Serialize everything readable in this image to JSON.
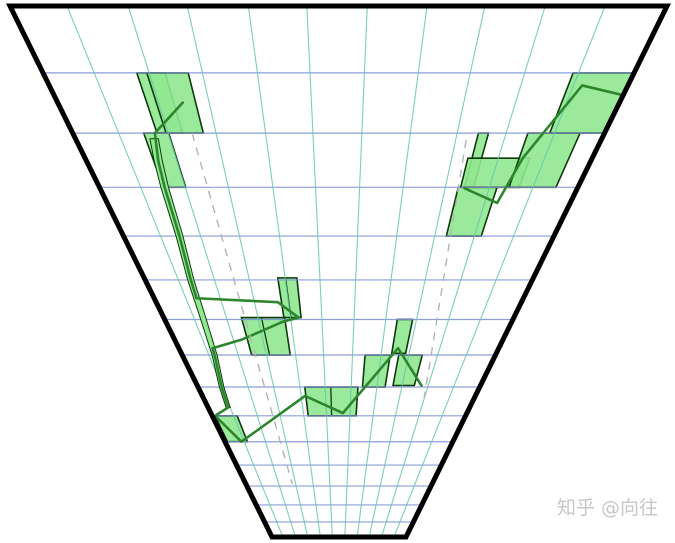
{
  "figure": {
    "width": 675,
    "height": 543,
    "background": "#ffffff"
  },
  "watermark": {
    "text": "知乎 @向往",
    "color": "#c7c7c7",
    "font_size": 19,
    "x": 658,
    "y": 514
  },
  "chart_data": {
    "type": "other",
    "description": "Perspective 'time funnel' rendering of a candlestick chart: light-green candle bodies with dark-green borders, a dark-green price polyline, two gray dashed trend rays, horizontal blue level lines and converging green vertical gridlines inside a thick black trapezoid frame.",
    "projection": {
      "vp_x": 339,
      "vp_y": 675,
      "scale": 669,
      "ratio": 0.9,
      "width_factor": 0.98206,
      "v_max": 15
    },
    "frame": {
      "corners": [
        [
          10,
          6
        ],
        [
          667,
          6
        ],
        [
          406,
          537
        ],
        [
          272,
          537
        ]
      ],
      "stroke": "#000000",
      "stroke_width": 5
    },
    "h_levels": {
      "v": [
        1,
        2,
        3,
        4,
        5,
        6,
        7,
        8,
        9,
        10,
        11,
        12,
        13,
        14
      ],
      "color": "#8093d8",
      "width": 1.2,
      "opacity": 0.9
    },
    "v_gridlines": {
      "u": [
        0.086,
        0.179,
        0.269,
        0.362,
        0.451,
        0.543,
        0.634,
        0.722,
        0.814,
        0.905
      ],
      "color": "#66c7a6",
      "width": 1.1,
      "opacity": 0.85
    },
    "candles": {
      "fill": "#90e890",
      "fill_opacity": 0.9,
      "stroke": "#0c3a0c",
      "stroke_width": 1.6,
      "items": [
        {
          "name": "a-narrow",
          "u1": 0.158,
          "u2": 0.206,
          "v1": 1.0,
          "v2": 2.0
        },
        {
          "name": "a-wide",
          "u1": 0.175,
          "u2": 0.245,
          "v1": 1.0,
          "v2": 2.0
        },
        {
          "name": "b",
          "u1": 0.133,
          "u2": 0.18,
          "v1": 2.0,
          "v2": 3.0
        },
        {
          "name": "d",
          "u1": 0.013,
          "u2": 0.1,
          "v1": 9.0,
          "v2": 10.0
        },
        {
          "name": "p",
          "u1": 0.343,
          "u2": 0.392,
          "v1": 4.95,
          "v2": 5.95,
          "divider_u": 0.363
        },
        {
          "name": "q",
          "u1": 0.222,
          "u2": 0.345,
          "v1": 5.95,
          "v2": 7.0,
          "divider_u": 0.279
        },
        {
          "name": "e",
          "u1": 0.379,
          "u2": 0.567,
          "v1": 8.0,
          "v2": 9.0,
          "divider_u": 0.471
        },
        {
          "name": "f",
          "u1": 0.583,
          "u2": 0.663,
          "v1": 7.0,
          "v2": 8.0
        },
        {
          "name": "g",
          "u1": 0.667,
          "u2": 0.711,
          "v1": 6.0,
          "v2": 6.95
        },
        {
          "name": "h",
          "u1": 0.69,
          "u2": 0.765,
          "v1": 7.0,
          "v2": 7.95
        },
        {
          "name": "t",
          "u1": 0.762,
          "u2": 0.781,
          "v1": 2.0,
          "v2": 3.0
        },
        {
          "name": "v-box",
          "u1": 0.754,
          "u2": 0.876,
          "v1": 2.45,
          "v2": 3.0
        },
        {
          "name": "n",
          "u1": 0.749,
          "u2": 0.83,
          "v1": 3.0,
          "v2": 4.0
        },
        {
          "name": "r",
          "u1": 0.855,
          "u2": 0.953,
          "v1": 2.0,
          "v2": 3.0
        },
        {
          "name": "big-top-right",
          "u1": 0.896,
          "u2": 1.005,
          "v1": 1.0,
          "v2": 2.0
        }
      ]
    },
    "sliver": {
      "points": [
        [
          0.149,
          2.1
        ],
        [
          0.142,
          2.5
        ],
        [
          0.136,
          3.0
        ],
        [
          0.13,
          4.0
        ],
        [
          0.118,
          5.0
        ],
        [
          0.112,
          6.0
        ],
        [
          0.104,
          7.0
        ],
        [
          0.085,
          8.0
        ],
        [
          0.078,
          8.7
        ]
      ],
      "half_width": 0.008,
      "fill": "#90e890",
      "stroke": "#0c3a0c",
      "stroke_width": 1
    },
    "price_lines": {
      "color": "#2d862d",
      "width": 2.6,
      "paths": [
        [
          [
            0.222,
            1.48
          ],
          [
            0.154,
            2.0
          ],
          [
            0.142,
            2.5
          ],
          [
            0.136,
            3.0
          ],
          [
            0.13,
            4.0
          ],
          [
            0.118,
            5.0
          ],
          [
            0.115,
            5.45
          ],
          [
            0.333,
            5.55
          ],
          [
            0.385,
            5.95
          ],
          [
            0.341,
            6.05
          ],
          [
            0.206,
            6.55
          ],
          [
            0.106,
            6.8
          ],
          [
            0.104,
            7.0
          ],
          [
            0.085,
            8.0
          ],
          [
            0.078,
            8.7
          ],
          [
            0.013,
            9.0
          ],
          [
            0.074,
            10.0
          ],
          [
            0.376,
            8.3
          ],
          [
            0.515,
            8.9
          ],
          [
            0.684,
            6.8
          ],
          [
            0.79,
            7.95
          ]
        ],
        [
          [
            0.763,
            3.02
          ],
          [
            0.841,
            3.31
          ],
          [
            0.862,
            2.45
          ],
          [
            0.92,
            1.2
          ],
          [
            1.0,
            1.36
          ]
        ]
      ]
    },
    "dashed_lines": {
      "color": "#b3b3b3",
      "width": 1.4,
      "dash": "8 7",
      "segments": [
        [
          [
            0.224,
            2.0
          ],
          [
            0.251,
            11.9
          ]
        ],
        [
          [
            0.742,
            2.12
          ],
          [
            0.813,
            8.37
          ]
        ]
      ]
    }
  }
}
